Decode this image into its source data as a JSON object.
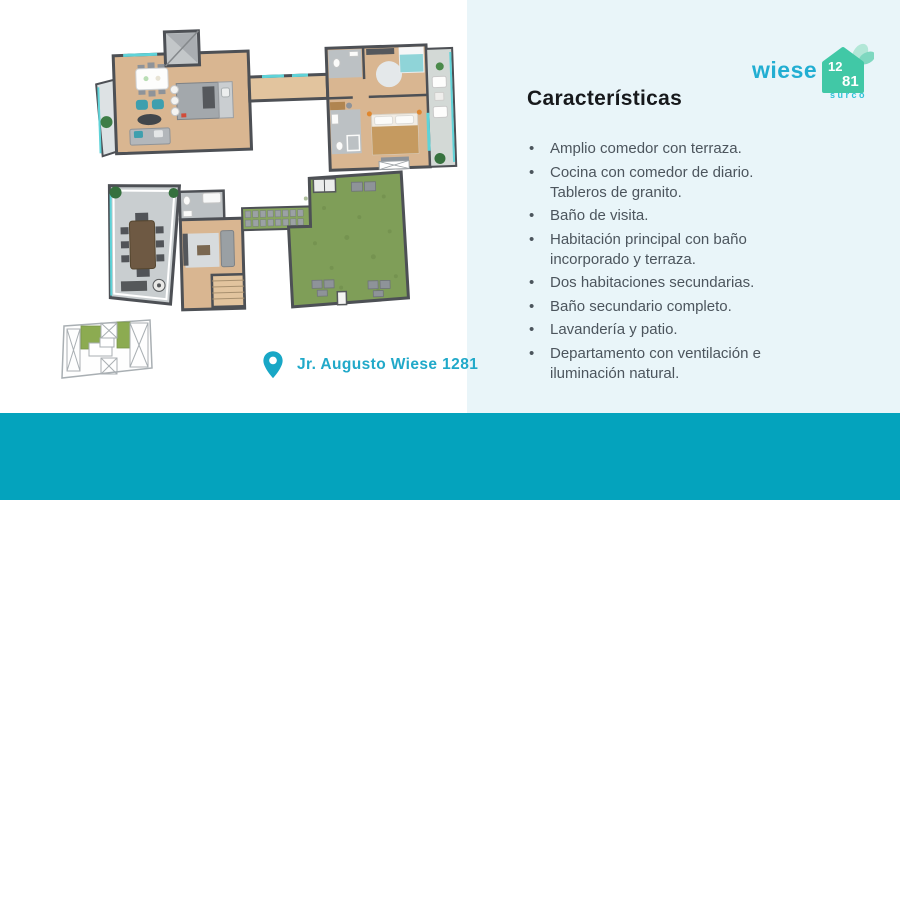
{
  "brand": {
    "name": "wiese",
    "address_number_top": "12",
    "address_number_bottom": "81",
    "district": "surco"
  },
  "features": {
    "title": "Características",
    "bullet_char": "•",
    "items": [
      "Amplio comedor con terraza.",
      "Cocina con comedor de diario.\nTableros de granito.",
      "Baño de visita.",
      "Habitación principal con baño\nincorporado y terraza.",
      "Dos habitaciones secundarias.",
      "Baño secundario completo.",
      "Lavandería y patio.",
      "Departamento con ventilación e\niluminación natural."
    ]
  },
  "location": {
    "address": "Jr. Augusto Wiese 1281"
  },
  "footer": {
    "unit": "DPTO 601",
    "description": "Duplex de 3 dormitorios + estar",
    "areas": [
      {
        "label": "Área Techada",
        "value": "121m2"
      },
      {
        "label": "Área Total",
        "value": "189m2"
      },
      {
        "label": "Área Libre",
        "value": "68m2"
      }
    ]
  },
  "colors": {
    "footer_teal": "#04a3bd",
    "accent_text": "#21a9c9",
    "logo_blue": "#22aed2",
    "house_green": "#41c8a6",
    "panel_bg": "#e9f5f9",
    "lawn_green": "#7f9e58",
    "wood_floor": "#d9b691"
  }
}
